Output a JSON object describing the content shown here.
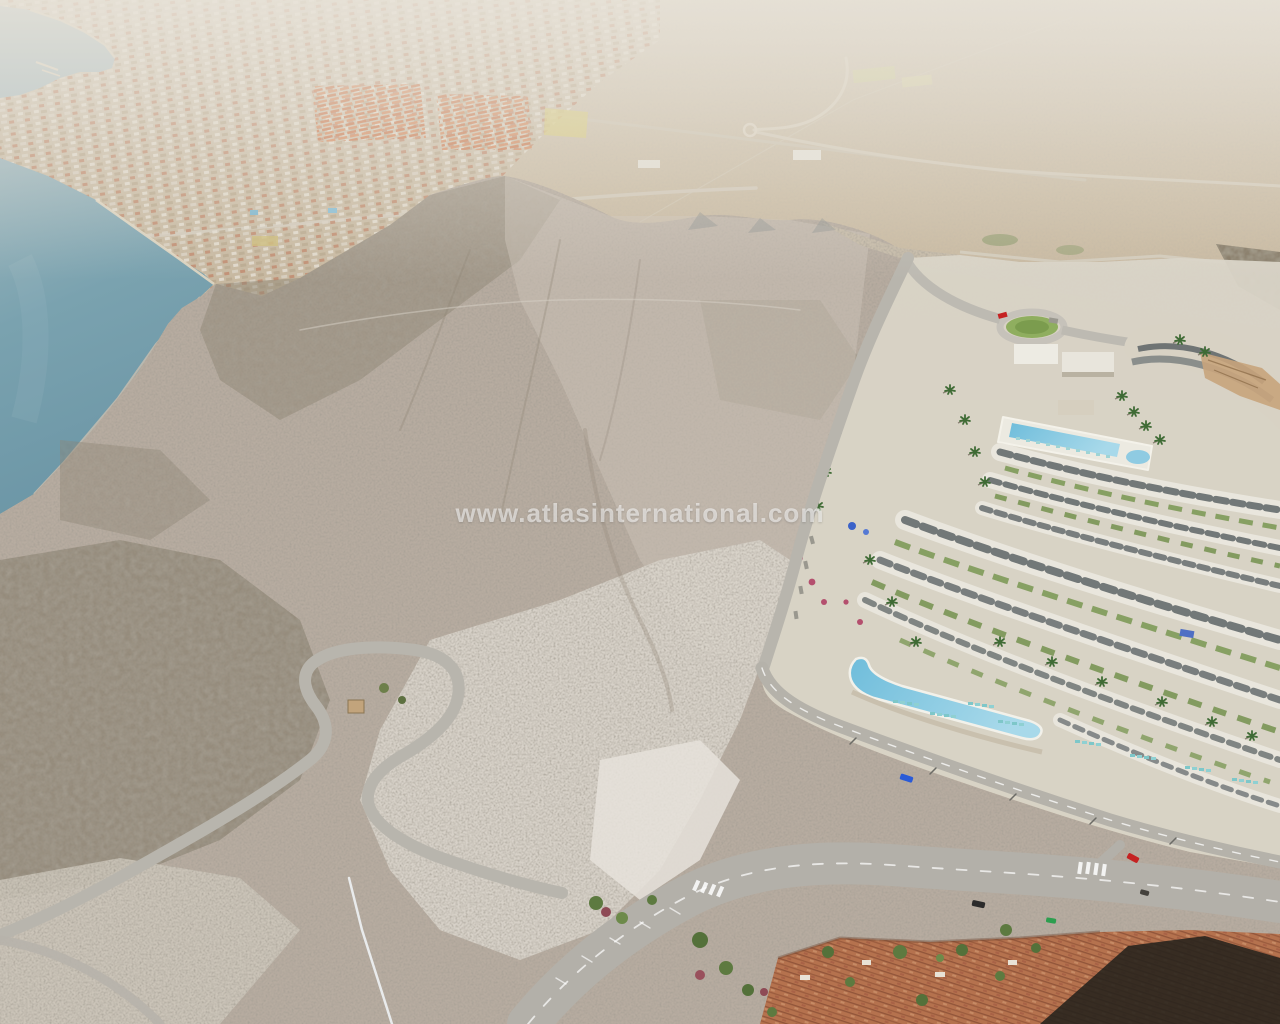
{
  "scene": {
    "type": "aerial-3d-render",
    "description": "Aerial render of a barren coastal mountain beside the sea with a terraced resort development, desert plain behind, serpentine access roads and a terracotta-roofed village at the bottom",
    "watermark": "www.atlasinternational.com"
  },
  "palette": {
    "sea": "#6f9aa9",
    "sea_far": "#9db6bd",
    "bay": "#aabdc2",
    "desert_plain": "#c9b9a2",
    "haze": "#e6e1d6",
    "town": "#cabfae",
    "town_roofs": "#bb8068",
    "orange_housing": "#cb7950",
    "mountain": "#b7aca0",
    "scrub": "#867c6a",
    "bare_rock": "#dcd7cd",
    "resort_hardscape": "#dad5c8",
    "building_white": "#edebe3",
    "glazing": "#5d6466",
    "pool_turquoise": "#6fbddb",
    "pool_light": "#a8d9ea",
    "garden_green": "#7e9a58",
    "palm_green": "#3f6b35",
    "road_asphalt": "#b3b0a9",
    "road_markings": "#ffffff",
    "terracotta_roofs": "#b5724e",
    "cast_shadow": "#24211c",
    "car_blue": "#2a5bd7",
    "car_red": "#c52222",
    "car_green": "#2d9e4f",
    "car_black": "#2b2b2b",
    "watermark_color": "#ffffff"
  },
  "elements": [
    "bay-water",
    "marina-piers",
    "coastal-town",
    "orange-housing-rows",
    "desert-plain",
    "plain-roads",
    "plain-roundabout",
    "sea",
    "mountain-ridge",
    "scrub-slopes",
    "excavated-rock",
    "hairpin-road",
    "slope-road",
    "resort-development",
    "roundabout-lawn",
    "arc-building",
    "rooftop-pool",
    "lap-pool",
    "terrace-buildings",
    "sun-loungers",
    "palm-trees",
    "flower-shrubs",
    "access-road",
    "avenue",
    "boulevard",
    "crosswalks",
    "blue-car",
    "red-car",
    "black-suv",
    "green-car",
    "terracotta-houses",
    "cliff-shadow",
    "watermark"
  ]
}
